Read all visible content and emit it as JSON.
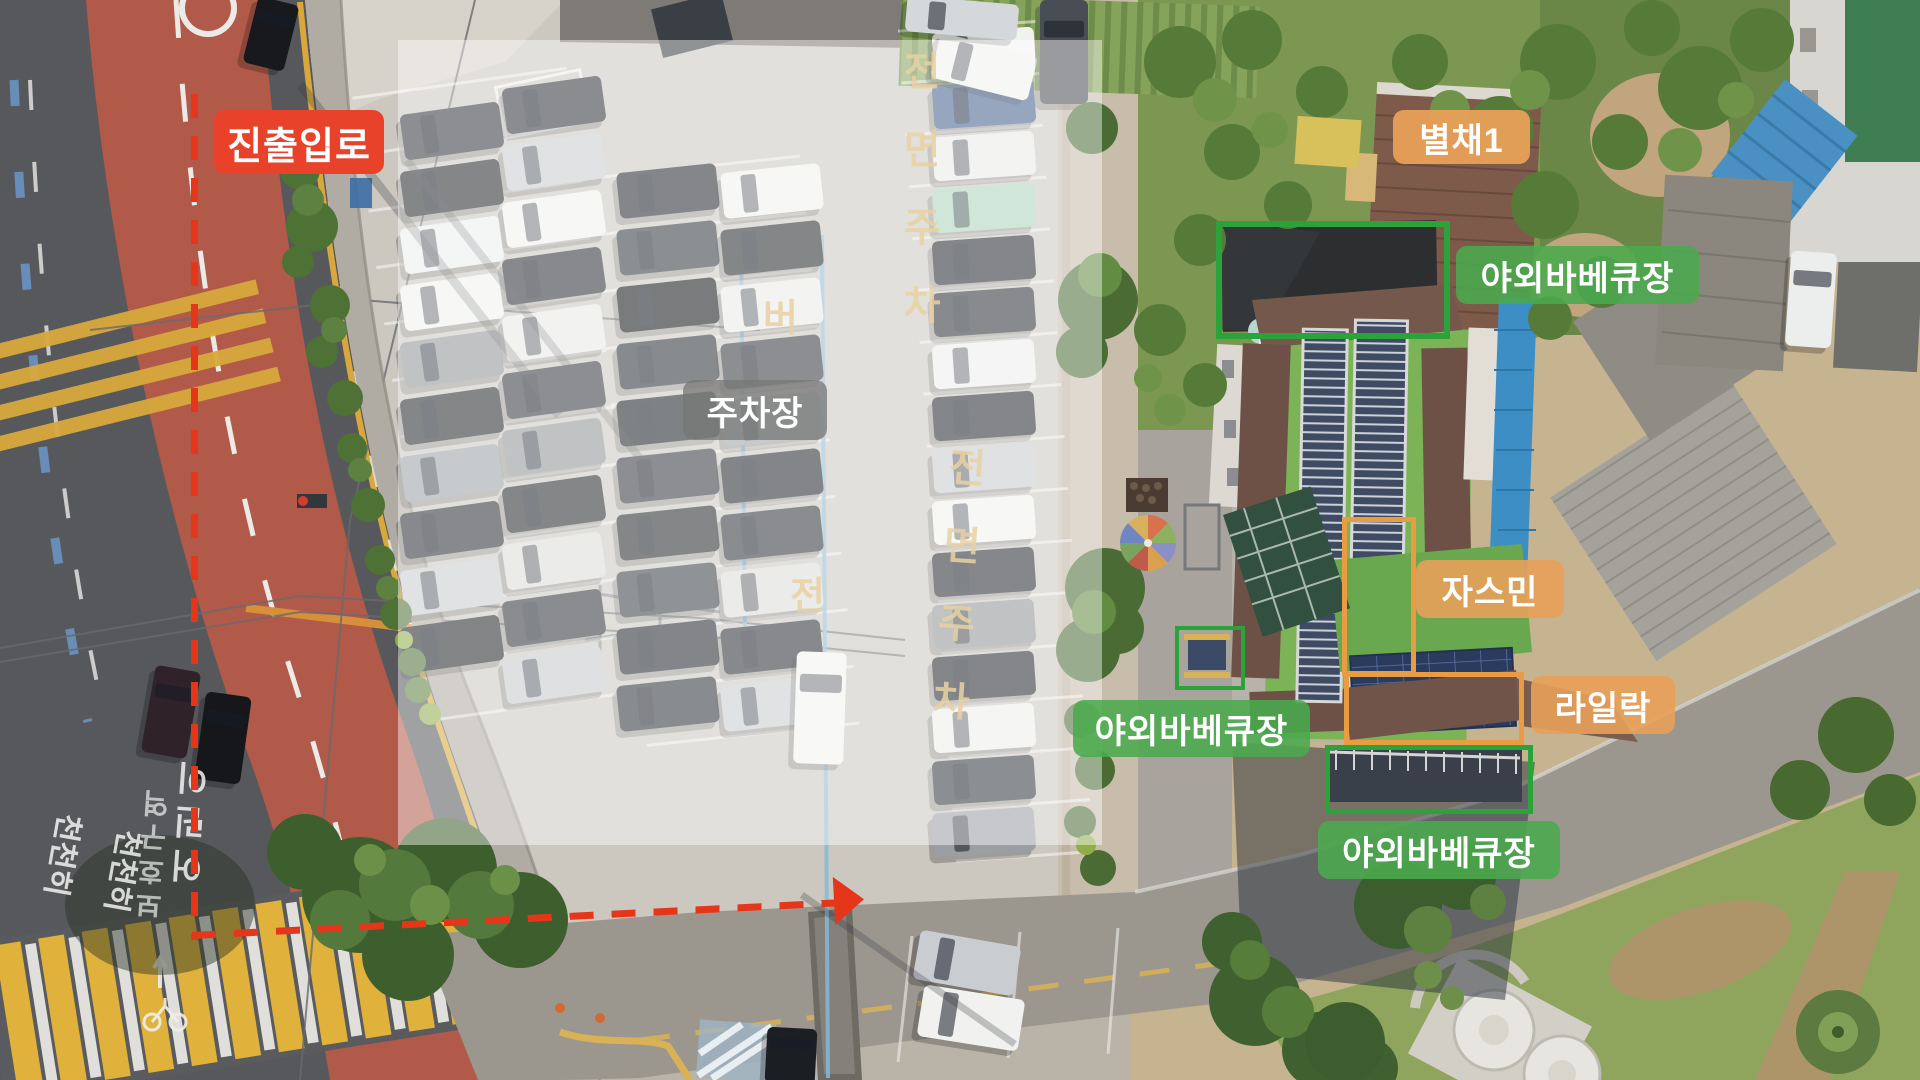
{
  "annotations": {
    "entry_route": {
      "label": "진출입로",
      "color": "#e8432a"
    },
    "annex1": {
      "label": "별채1",
      "color": "#e8a059"
    },
    "bbq_top": {
      "label": "야외바베큐장",
      "color": "#4aaa4d"
    },
    "parking": {
      "label": "주차장",
      "color": "#7d7d7d"
    },
    "jasmine": {
      "label": "자스민",
      "color": "#e8a059"
    },
    "lilac": {
      "label": "라일락",
      "color": "#e8a059"
    },
    "bbq_mid": {
      "label": "야외바베큐장",
      "color": "#4aaa4d"
    },
    "bbq_bottom": {
      "label": "야외바베큐장",
      "color": "#4aaa4d"
    }
  },
  "route_arrow": {
    "color": "#e5361a",
    "style": "dashed"
  },
  "highlight_boxes": {
    "green": "#2ca23a",
    "orange": "#ea9c42"
  },
  "pavement": {
    "front_parking_1": "전면주차",
    "front_parking_2": "전면주차",
    "bus_zone_char_1": "버",
    "bus_zone_char_2": "전",
    "school_zone_1": "어린이",
    "school_zone_2": "보호구역",
    "slow_1": "천천히",
    "slow_2": "천천히"
  }
}
